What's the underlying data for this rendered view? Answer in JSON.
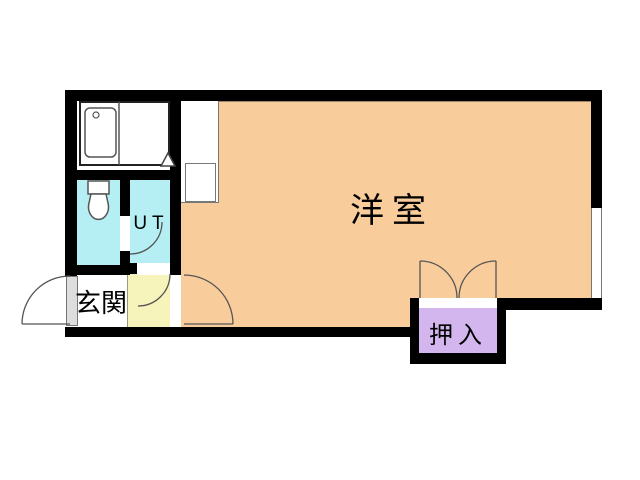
{
  "floorplan": {
    "type": "japanese-apartment-floor-plan",
    "rooms": {
      "main": {
        "label": "洋室",
        "color": "#F9CC9C"
      },
      "entrance": {
        "label": "玄関",
        "color": "#FFFFFF"
      },
      "utility": {
        "label": "UT",
        "color": "#B5EFF4"
      },
      "toilet": {
        "color": "#B5EFF4"
      },
      "kitchen": {
        "color": "#FFFFFF"
      },
      "corridor": {
        "color": "#F6F3BB"
      },
      "closet": {
        "label": "押入",
        "color": "#D3B6EE"
      }
    },
    "colors": {
      "wall": "#000000",
      "background": "#FFFFFF",
      "line": "#555555",
      "door_leaf": "#DDDDDD"
    }
  }
}
